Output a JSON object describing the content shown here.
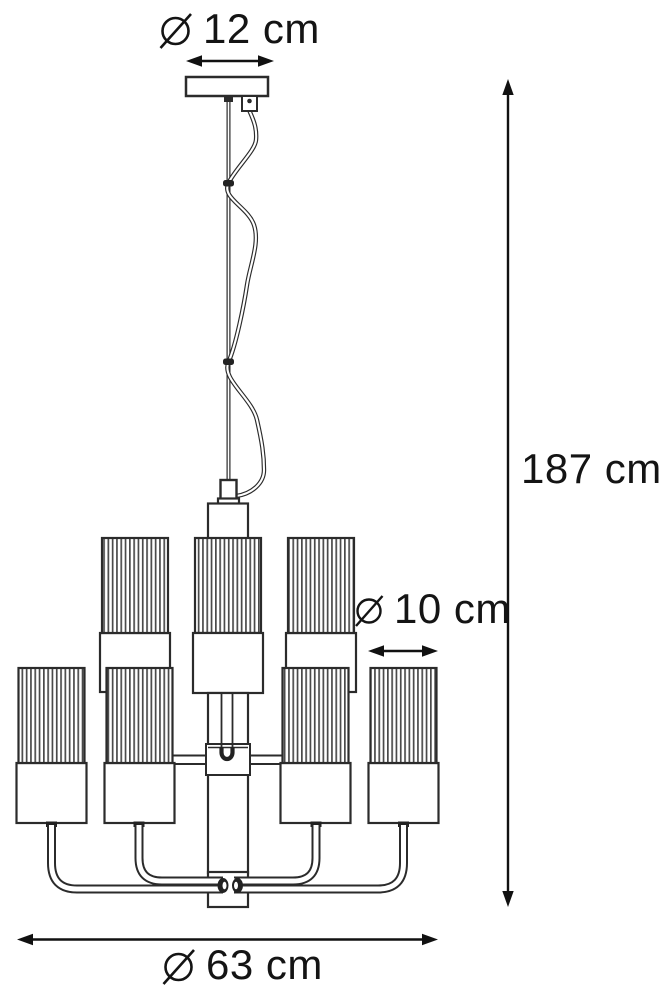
{
  "figure": {
    "title": "Chandelier dimension drawing",
    "background_color": "#ffffff",
    "line_color": "#2b2b2b",
    "text_color": "#141414"
  },
  "dimensions": {
    "canopy_diameter": {
      "symbol": "⌀",
      "value": "12 cm",
      "label": "⌀ 12 cm"
    },
    "total_height": {
      "value": "187 cm",
      "label": "187 cm"
    },
    "shade_diameter": {
      "symbol": "⌀",
      "value": "10 cm",
      "label": "⌀ 10 cm"
    },
    "fixture_diameter": {
      "symbol": "⌀",
      "value": "63 cm",
      "label": "⌀ 63 cm"
    }
  },
  "drawing": {
    "upper_tier_shades_visible": 3,
    "lower_tier_shades_visible": 4,
    "shade_style": "ribbed cylinder with plain socket band",
    "suspension": "ceiling canopy with rod and coiled power cord"
  }
}
